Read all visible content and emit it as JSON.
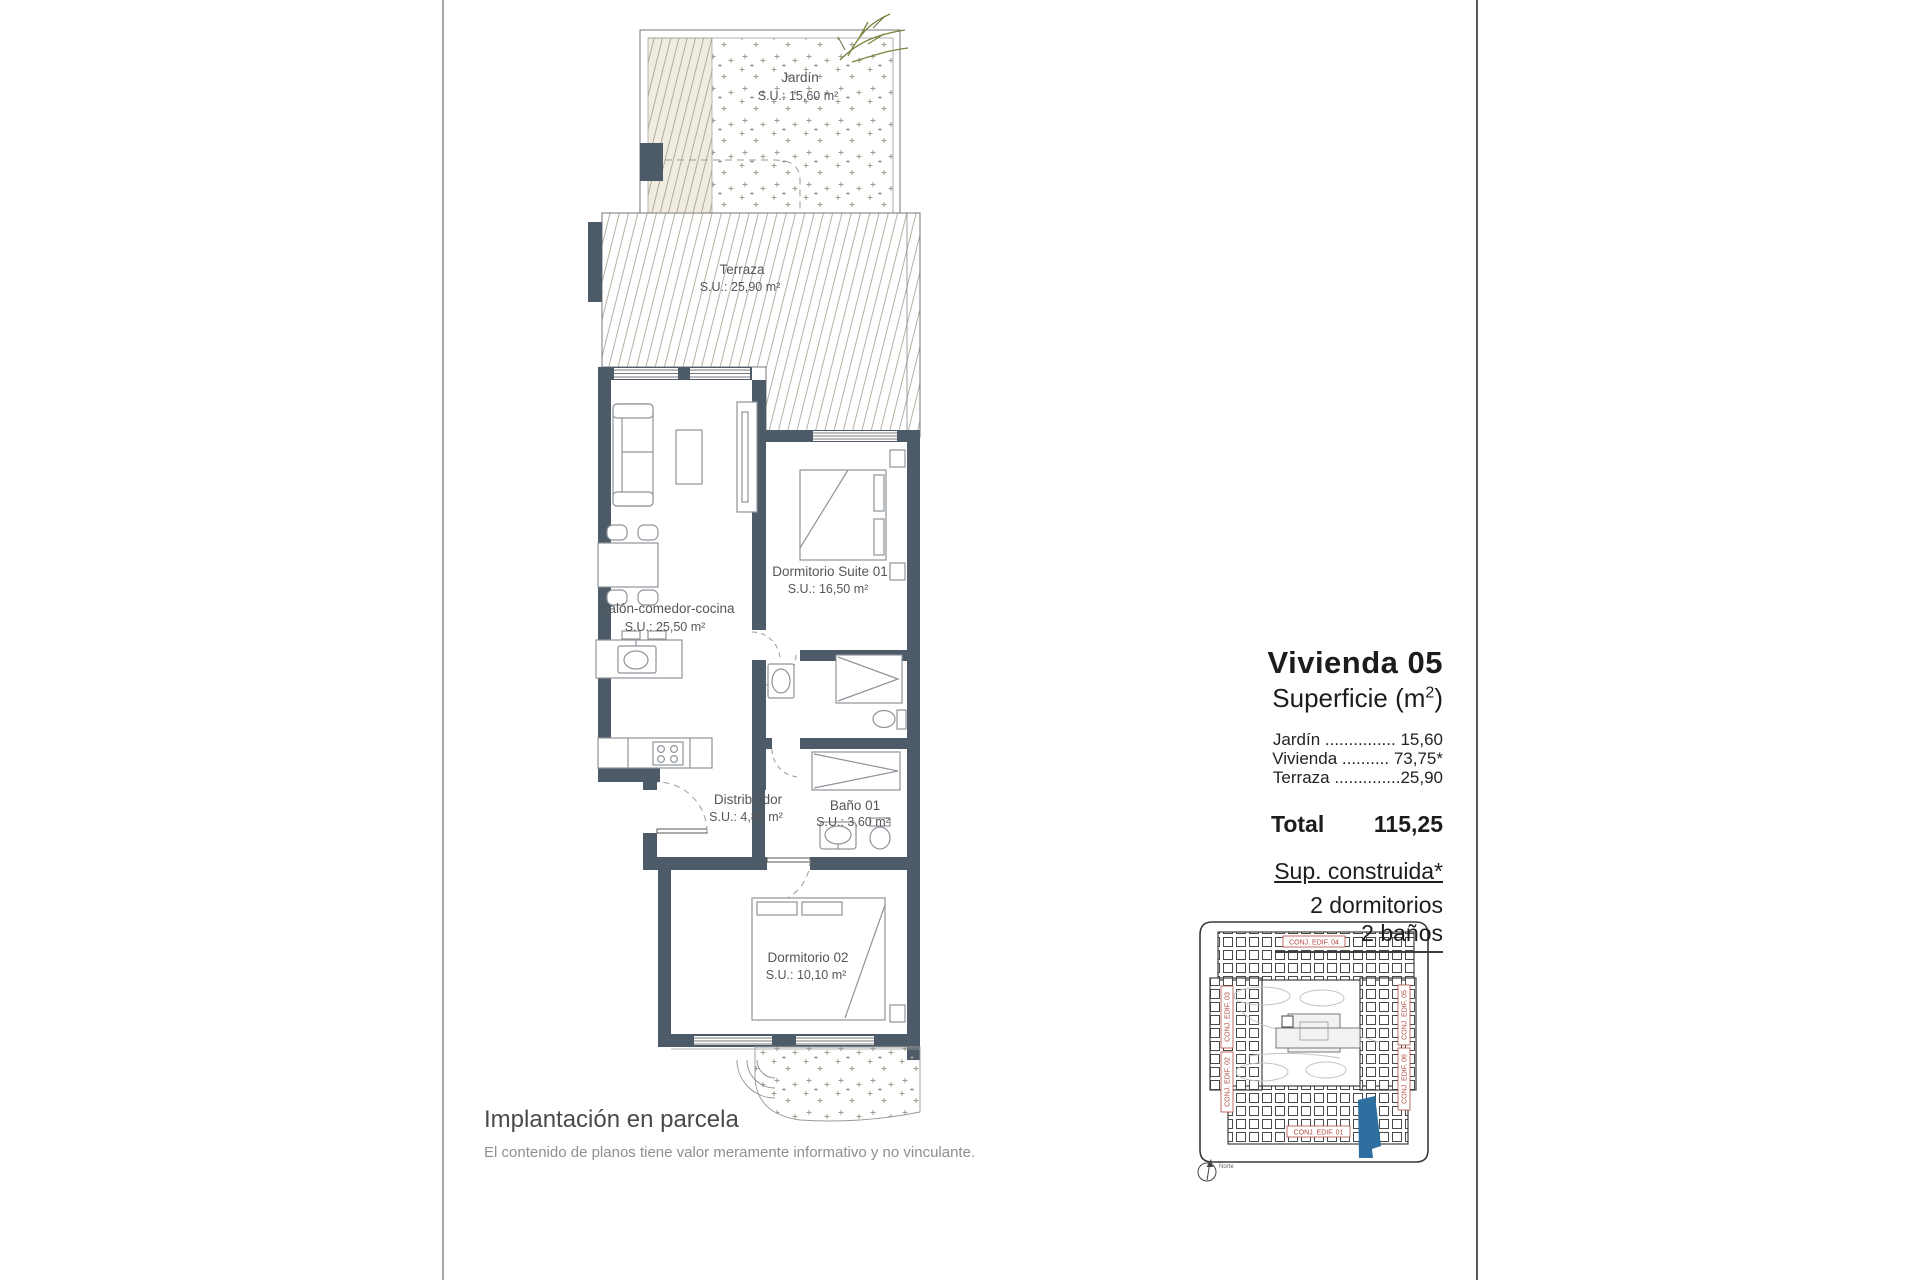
{
  "plan": {
    "rooms": {
      "jardin": {
        "name": "Jardín",
        "area": "S.U.: 15,60 m²"
      },
      "terraza": {
        "name": "Terraza",
        "area": "S.U.: 25,90 m²"
      },
      "salon": {
        "name": "Salón-comedor-cocina",
        "area": "S.U.: 25,50 m²"
      },
      "suite": {
        "name": "Dormitorio Suite 01",
        "area": "S.U.: 16,50 m²"
      },
      "distribuidor": {
        "name": "Distribuidor",
        "area": "S.U.: 4,80 m²"
      },
      "bano": {
        "name": "Baño 01",
        "area": "S.U.: 3,60 m²"
      },
      "dorm2": {
        "name": "Dormitorio 02",
        "area": "S.U.: 10,10 m²"
      }
    }
  },
  "info_panel": {
    "title": "Vivienda 05",
    "subtitle": {
      "prefix": "Superficie (m",
      "sup": "2",
      "suffix": ")"
    },
    "rows": [
      {
        "line": "Jardín ............... 15,60"
      },
      {
        "line": "Vivienda .......... 73,75*"
      },
      {
        "line": "Terraza ..............25,90"
      }
    ],
    "total_label": "Total",
    "total_value": "115,25",
    "constructed": "Sup. construida*",
    "bedrooms": "2 dormitorios",
    "bathrooms": "2 baños"
  },
  "caption": {
    "title": "Implantación en parcela",
    "disclaimer": "El contenido de planos tiene valor meramente informativo y no vinculante."
  },
  "site_plan": {
    "labels": {
      "top": "CONJ. EDIF. 04",
      "left_upper": "CONJ. EDIF. 03",
      "left_lower": "CONJ. EDIF. 02",
      "right_upper": "CONJ. EDIF. 05",
      "right_lower": "CONJ. EDIF. 06",
      "bottom": "CONJ. EDIF. 01"
    },
    "north": "Norte",
    "highlight_color": "#2f6f9f",
    "label_color": "#b04a3f"
  },
  "colors": {
    "wall": "#4d5b69",
    "accent_blue": "#2f6f9f",
    "label_red": "#b04a3f"
  }
}
